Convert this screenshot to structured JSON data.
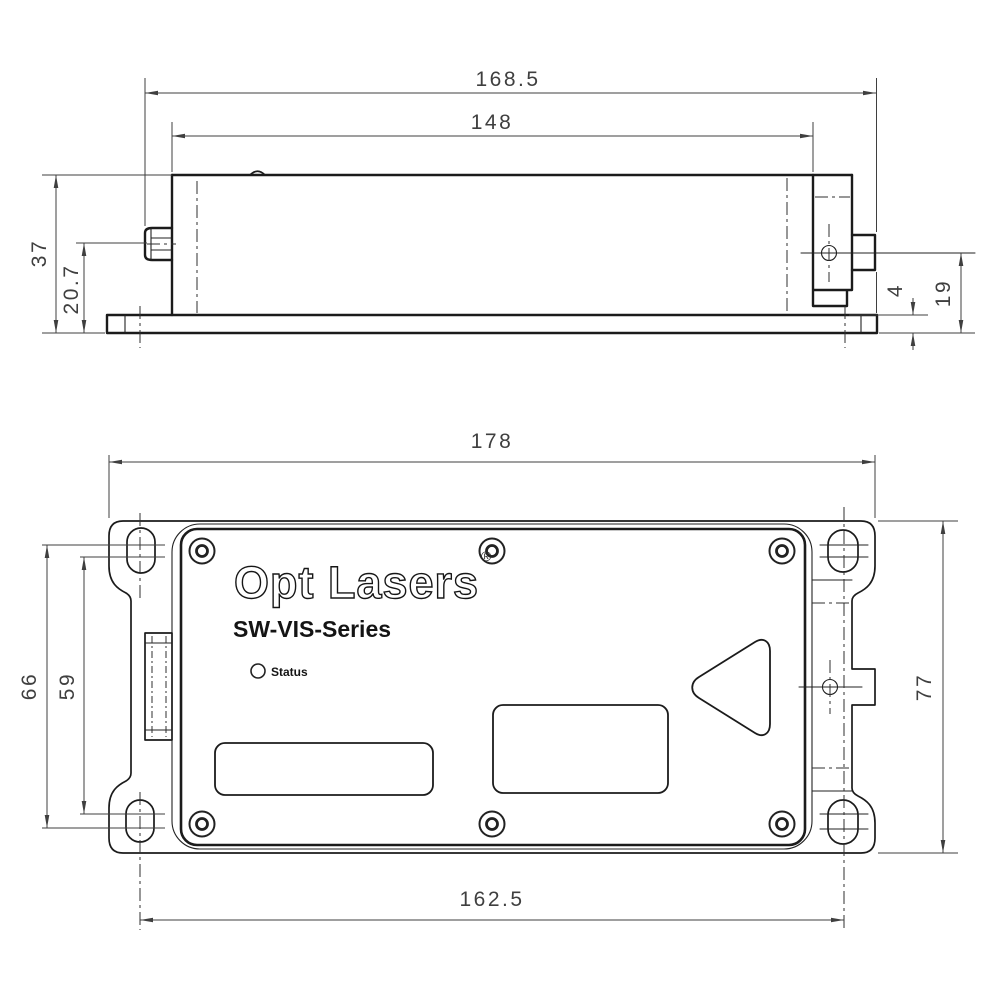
{
  "drawing": {
    "background": "#ffffff",
    "line_color": "#1b1b1b",
    "dimension_color": "#3f3f3f"
  },
  "side_view": {
    "dimensions": {
      "overall_length": "168.5",
      "housing_length": "148",
      "overall_height": "37",
      "connector_axis_height": "20.7",
      "base_plate_thickness": "4",
      "beam_axis_height": "19"
    }
  },
  "top_view": {
    "dimensions": {
      "overall_length": "178",
      "slot_span_outer": "66",
      "slot_span_inner": "59",
      "overall_width": "77",
      "mounting_slot_spacing": "162.5"
    },
    "labels": {
      "brand": "Opt Lasers",
      "registered_mark": "®",
      "series": "SW-VIS-Series",
      "status_led": "Status"
    }
  }
}
